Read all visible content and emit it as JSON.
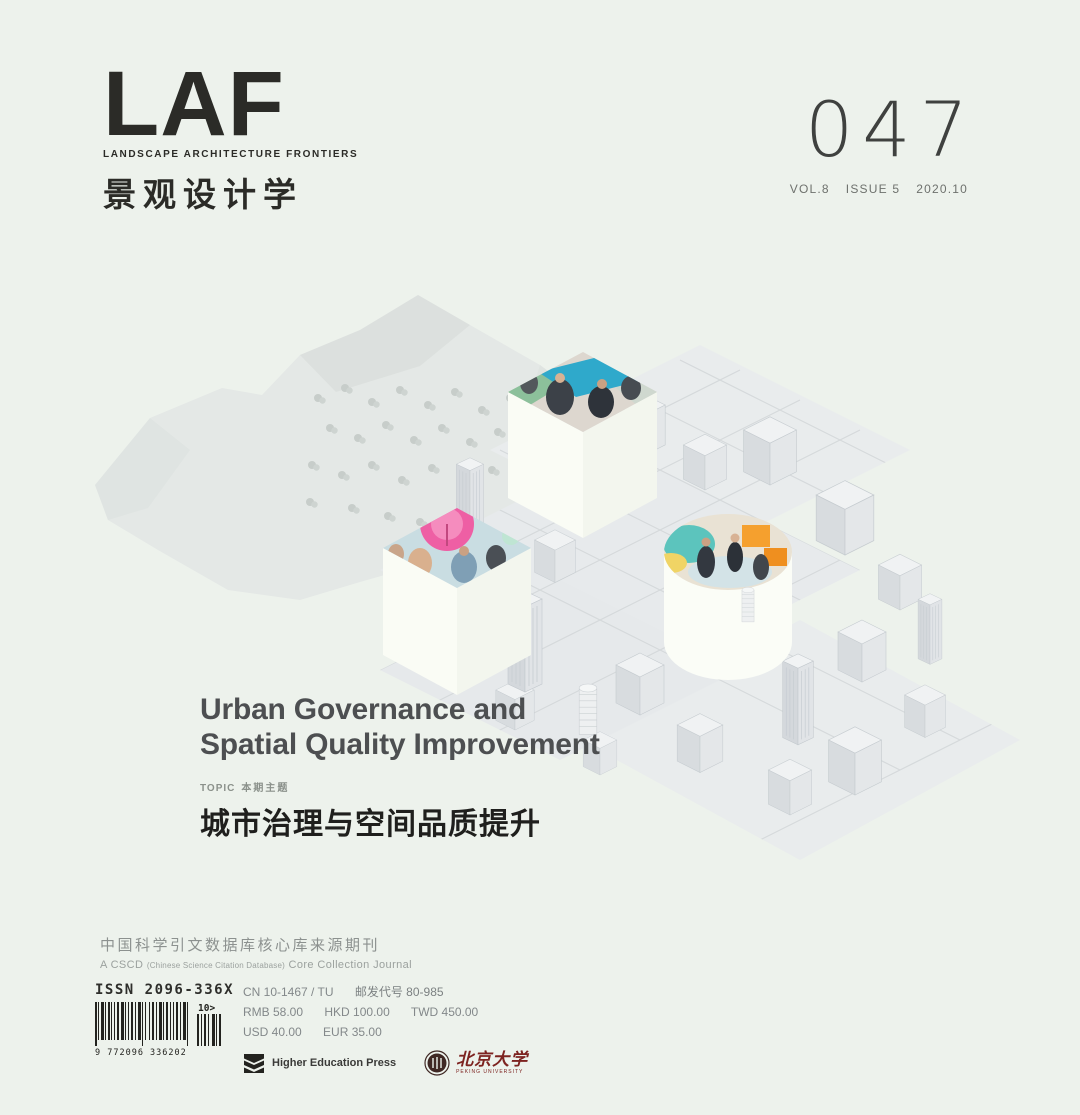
{
  "colors": {
    "background": "#edf2ec",
    "ink": "#2b2b27",
    "title_gray": "#4d4f51",
    "muted_gray": "#8c918f",
    "pku_red": "#7d2320",
    "photo_teal": "#2fa9cb",
    "photo_pink": "#ee5fa4",
    "photo_orange": "#f5a02e"
  },
  "masthead": {
    "logo_text": "LAF",
    "logo_tagline": "LANDSCAPE ARCHITECTURE FRONTIERS",
    "logo_cn": "景观设计学",
    "issue_number": "047",
    "volume": "VOL.8",
    "issue": "ISSUE 5",
    "date": "2020.10"
  },
  "feature": {
    "title_en_line1": "Urban Governance and",
    "title_en_line2": "Spatial Quality Improvement",
    "topic_label_en": "TOPIC",
    "topic_label_cn": "本期主题",
    "title_cn": "城市治理与空间品质提升"
  },
  "accreditation": {
    "line_cn": "中国科学引文数据库核心库来源期刊",
    "line_en_prefix": "A CSCD",
    "line_en_paren": "(Chinese Science Citation Database)",
    "line_en_suffix": "Core Collection Journal"
  },
  "imprint": {
    "issn": "ISSN 2096-336X",
    "barcode_digits": "9 772096 336202",
    "barcode_addon": "10>",
    "cn_code": "CN 10-1467 / TU",
    "postal_code": "邮发代号 80-985",
    "price_rmb": "RMB 58.00",
    "price_hkd": "HKD 100.00",
    "price_twd": "TWD 450.00",
    "price_usd": "USD 40.00",
    "price_eur": "EUR 35.00",
    "publisher_hep": "Higher Education Press",
    "publisher_pku_cn": "北京大学",
    "publisher_pku_en": "PEKING UNIVERSITY"
  }
}
